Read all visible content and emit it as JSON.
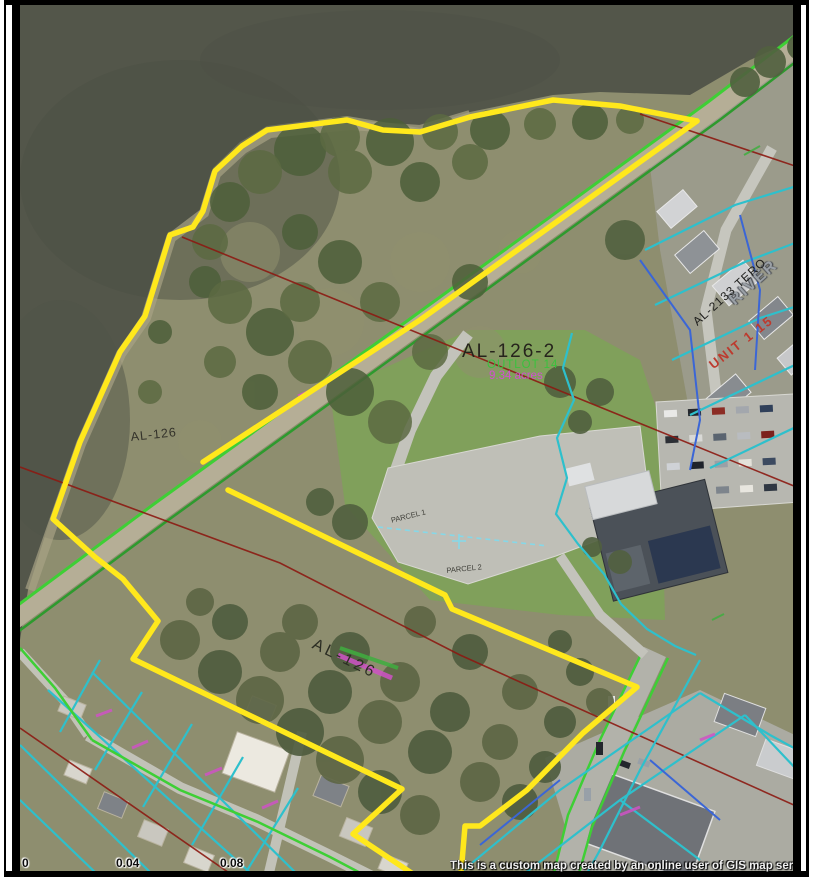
{
  "map": {
    "attribution": "This is a custom map created by an online user of GIS map services provided by",
    "scale_bar": {
      "tick0": "0",
      "tick1": "0.04",
      "tick2": "0.08"
    },
    "labels": {
      "parcel_main": "AL-126-2",
      "parcel_main_sub": "OUTLOT 14",
      "parcel_main_area": "9.34 acres",
      "parcel_upper": "AL-126",
      "parcel_lower": "AL-126",
      "street_river": "RIVER",
      "parcel_al2133": "AL-2133 TERO",
      "unit_label": "UNIT 1 15",
      "parcel1": "PARCEL 1",
      "parcel2": "PARCEL 2"
    },
    "colors": {
      "highlight": "#ffe81c",
      "parcel_line": "#2ec0cc",
      "lot_line_blue": "#3b66d6",
      "road_line": "#3ecf35",
      "section_line": "#8c1a12",
      "annotation_magenta": "#cf52c6"
    }
  }
}
